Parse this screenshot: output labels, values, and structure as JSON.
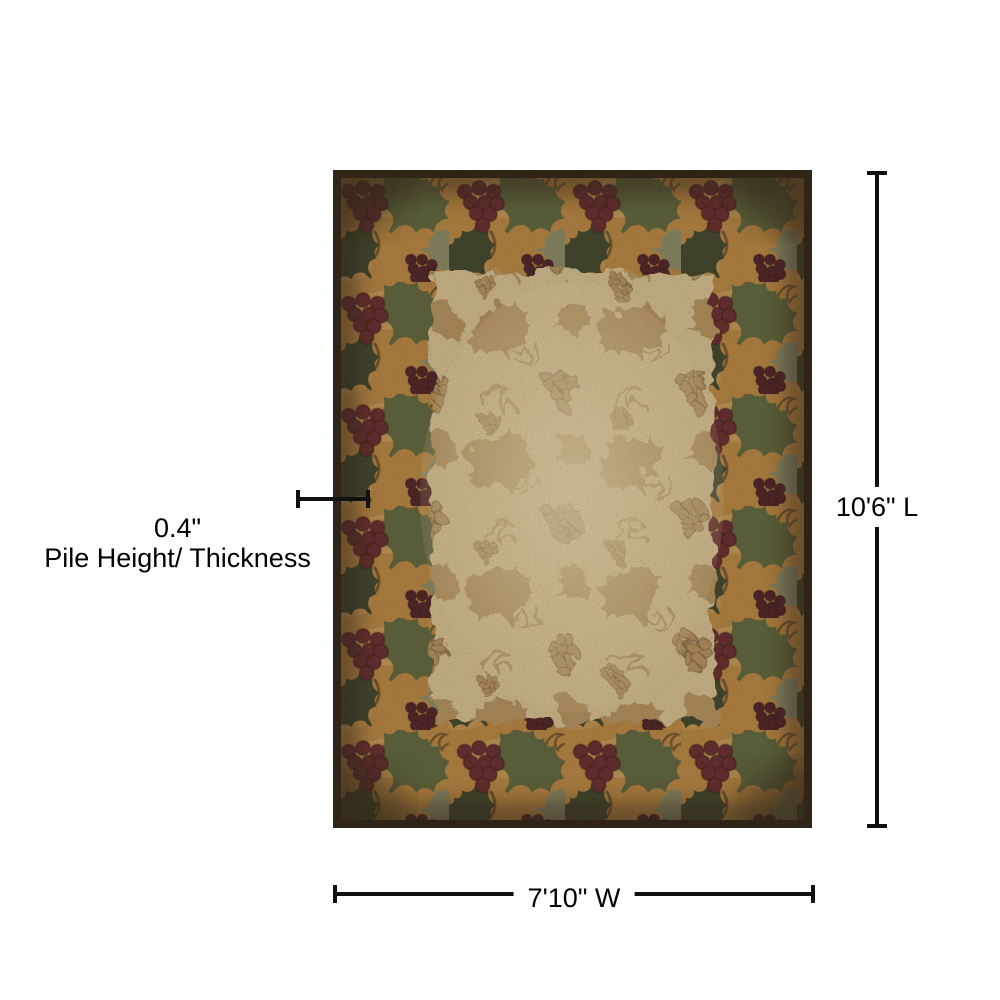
{
  "diagram": {
    "length_label": "10'6\" L",
    "width_label": "7'10\" W",
    "pile_height_value": "0.4\"",
    "pile_height_label": "Pile Height/ Thickness"
  },
  "colors": {
    "dimension_line": "#111111",
    "label_text": "#000000"
  },
  "rug": {
    "colors": {
      "outer_edge": "#1d130b",
      "border_gold": "#b8843e",
      "border_gold_light": "#d0a968",
      "border_shadow": "#241708",
      "grape": "#5e2029",
      "grape_dark": "#431620",
      "leaf_olive": "#556038",
      "leaf_dark": "#333d26",
      "leaf_sage": "#7e876a",
      "vine": "#6e4f26",
      "field_bg": "#d8c394",
      "field_motif": "#aa864e",
      "field_glow": "#ecdcb4"
    }
  }
}
